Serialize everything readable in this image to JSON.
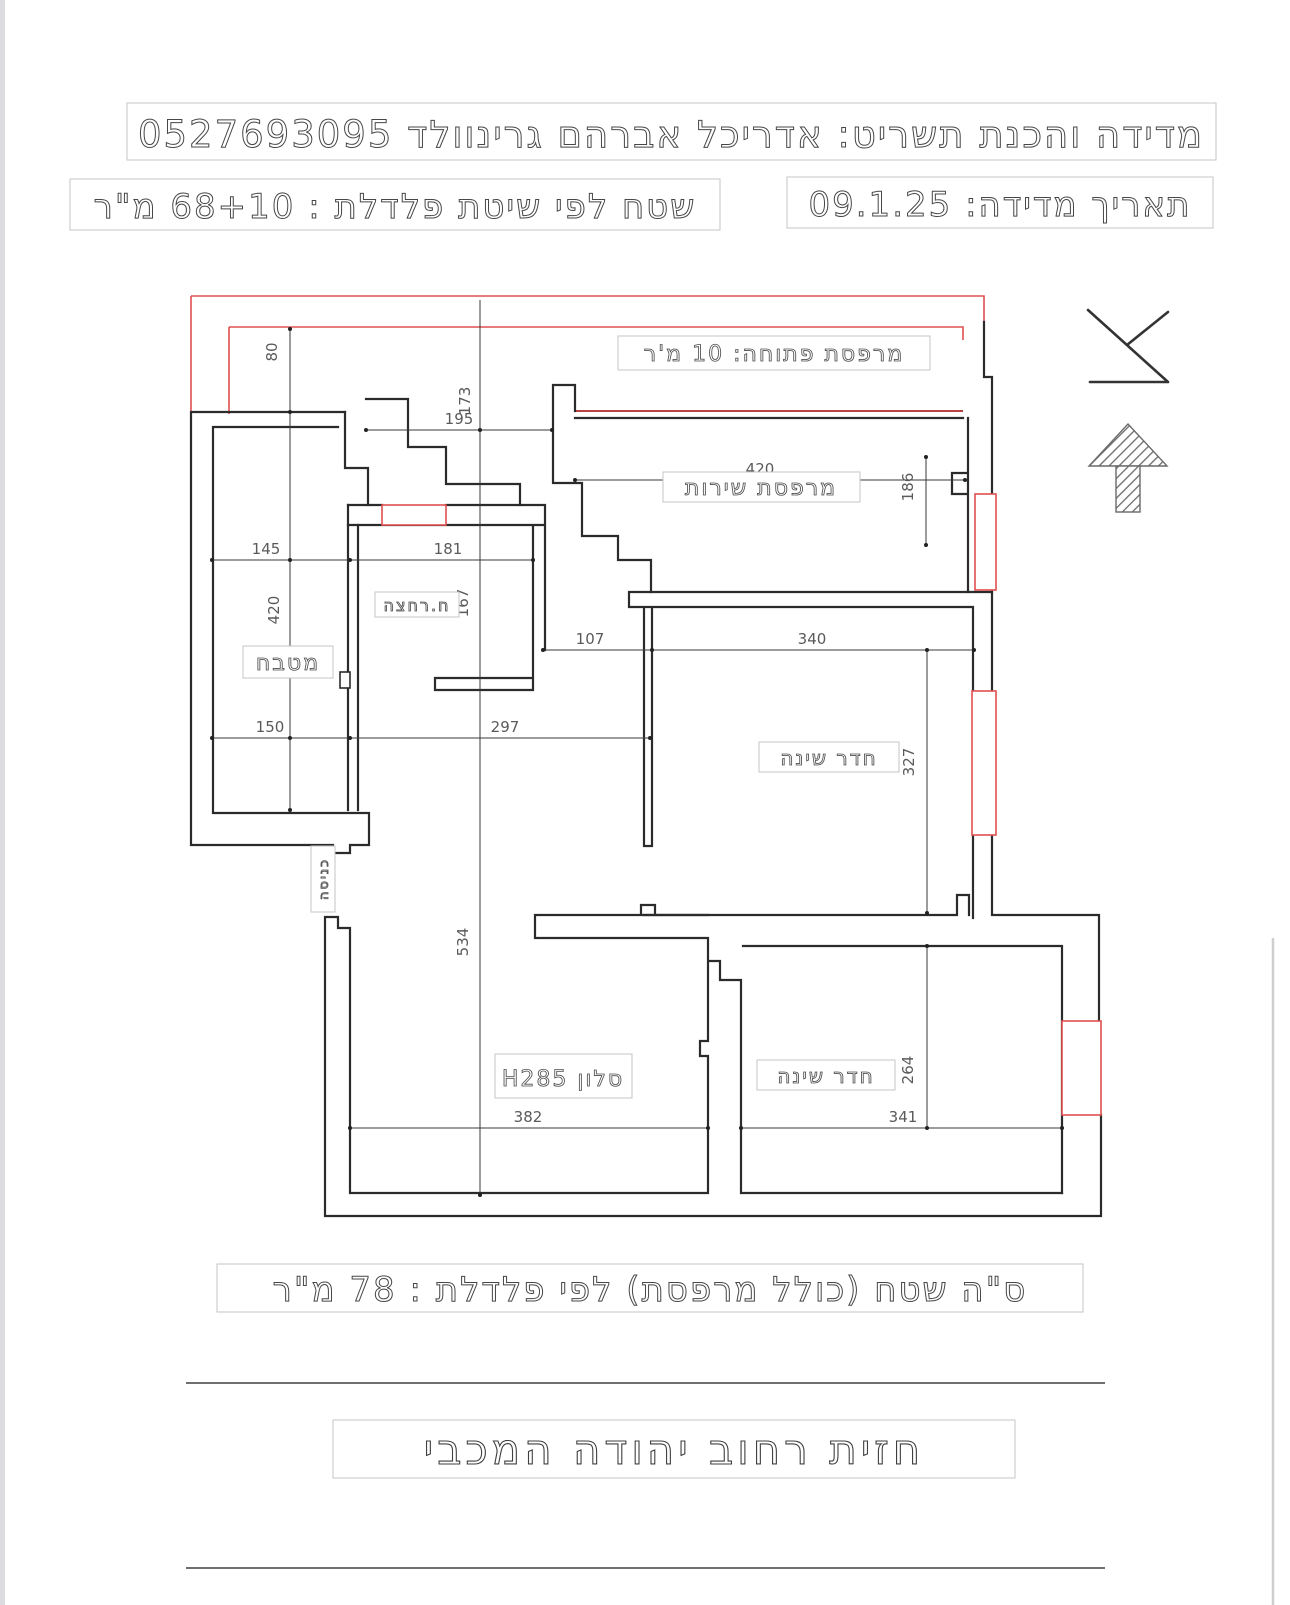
{
  "header": {
    "title_line": "מדידה והכנת תשריט: אדריכל אברהם גרינוולד 0527693095",
    "date_line": "תאריך מדידה: 09.1.25",
    "area_line": "שטח לפי שיטת פלדלת : 68+10 מ\"ר"
  },
  "rooms": {
    "open_balcony": "מרפסת פתוחה: 10 מ'ר",
    "service_balcony": "מרפסת שירות",
    "kitchen": "מטבח",
    "bathroom": "ח.רחצה",
    "bedroom_top": "חדר שינה",
    "bedroom_bottom": "חדר שינה",
    "living_room": "סלון H285",
    "entrance": "כניסה"
  },
  "dimensions": {
    "d80": "80",
    "d173": "173",
    "d195": "195",
    "d420_top": "420",
    "d186": "186",
    "d145": "145",
    "d181": "181",
    "d420_left": "420",
    "d167": "167",
    "d107": "107",
    "d340": "340",
    "d327": "327",
    "d150": "150",
    "d297": "297",
    "d534": "534",
    "d382": "382",
    "d341": "341",
    "d264": "264"
  },
  "footer": {
    "total_line": "ס\"ה שטח (כולל מרפסת) לפי פלדלת : 78 מ\"ר",
    "street_line": "חזית רחוב יהודה המכבי"
  },
  "colors": {
    "wall": "#2b2b2b",
    "envelope": "#e05050",
    "text": "#4a4a4a"
  }
}
